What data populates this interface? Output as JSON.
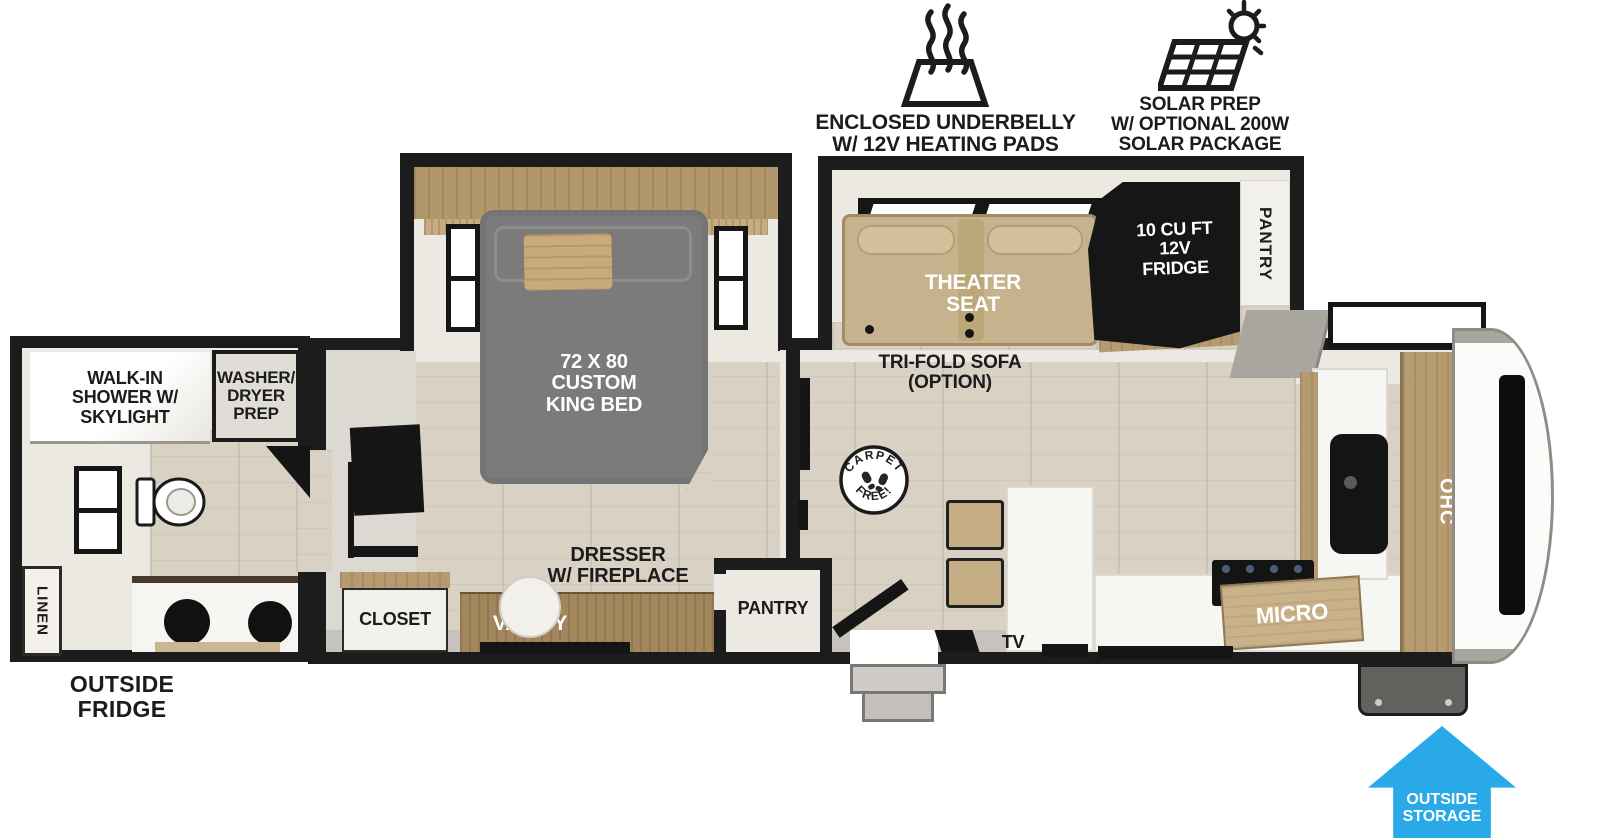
{
  "features": {
    "underbelly": {
      "icon": "heating-pads-icon",
      "label": "ENCLOSED UNDERBELLY\nW/ 12V HEATING PADS"
    },
    "solar": {
      "icon": "solar-panel-icon",
      "label": "SOLAR PREP\nW/ OPTIONAL 200W\nSOLAR PACKAGE"
    }
  },
  "bathroom": {
    "shower_label": "WALK-IN\nSHOWER W/\nSKYLIGHT",
    "washer_dryer_label": "WASHER/\nDRYER\nPREP",
    "linen_label": "LINEN",
    "outside_fridge_label": "OUTSIDE\nFRIDGE"
  },
  "bedroom": {
    "bed_label": "72 X 80\nCUSTOM\nKING BED",
    "closet_label": "CLOSET",
    "vanity_label": "VANITY",
    "dresser_label": "DRESSER\nW/ FIREPLACE",
    "pantry_label": "PANTRY"
  },
  "living": {
    "theater_label": "THEATER\nSEAT",
    "sofa_label": "TRI-FOLD SOFA\n(OPTION)",
    "fridge_label": "10 CU FT\n12V\nFRIDGE",
    "pantry_label": "PANTRY",
    "carpet_badge": {
      "top": "CARPET",
      "bottom": "FREE!"
    }
  },
  "kitchen": {
    "tv_label": "TV",
    "micro_label": "MICRO",
    "ohc_label": "OHC"
  },
  "exterior": {
    "outside_storage_label": "OUTSIDE\nSTORAGE"
  },
  "colors": {
    "accent_blue": "#29A9E8",
    "wall_black": "#1c1c1c",
    "sofa_tan": "#c6b28c",
    "bed_gray": "#7b7b7b",
    "floor_wood": "#d8d1c4"
  }
}
